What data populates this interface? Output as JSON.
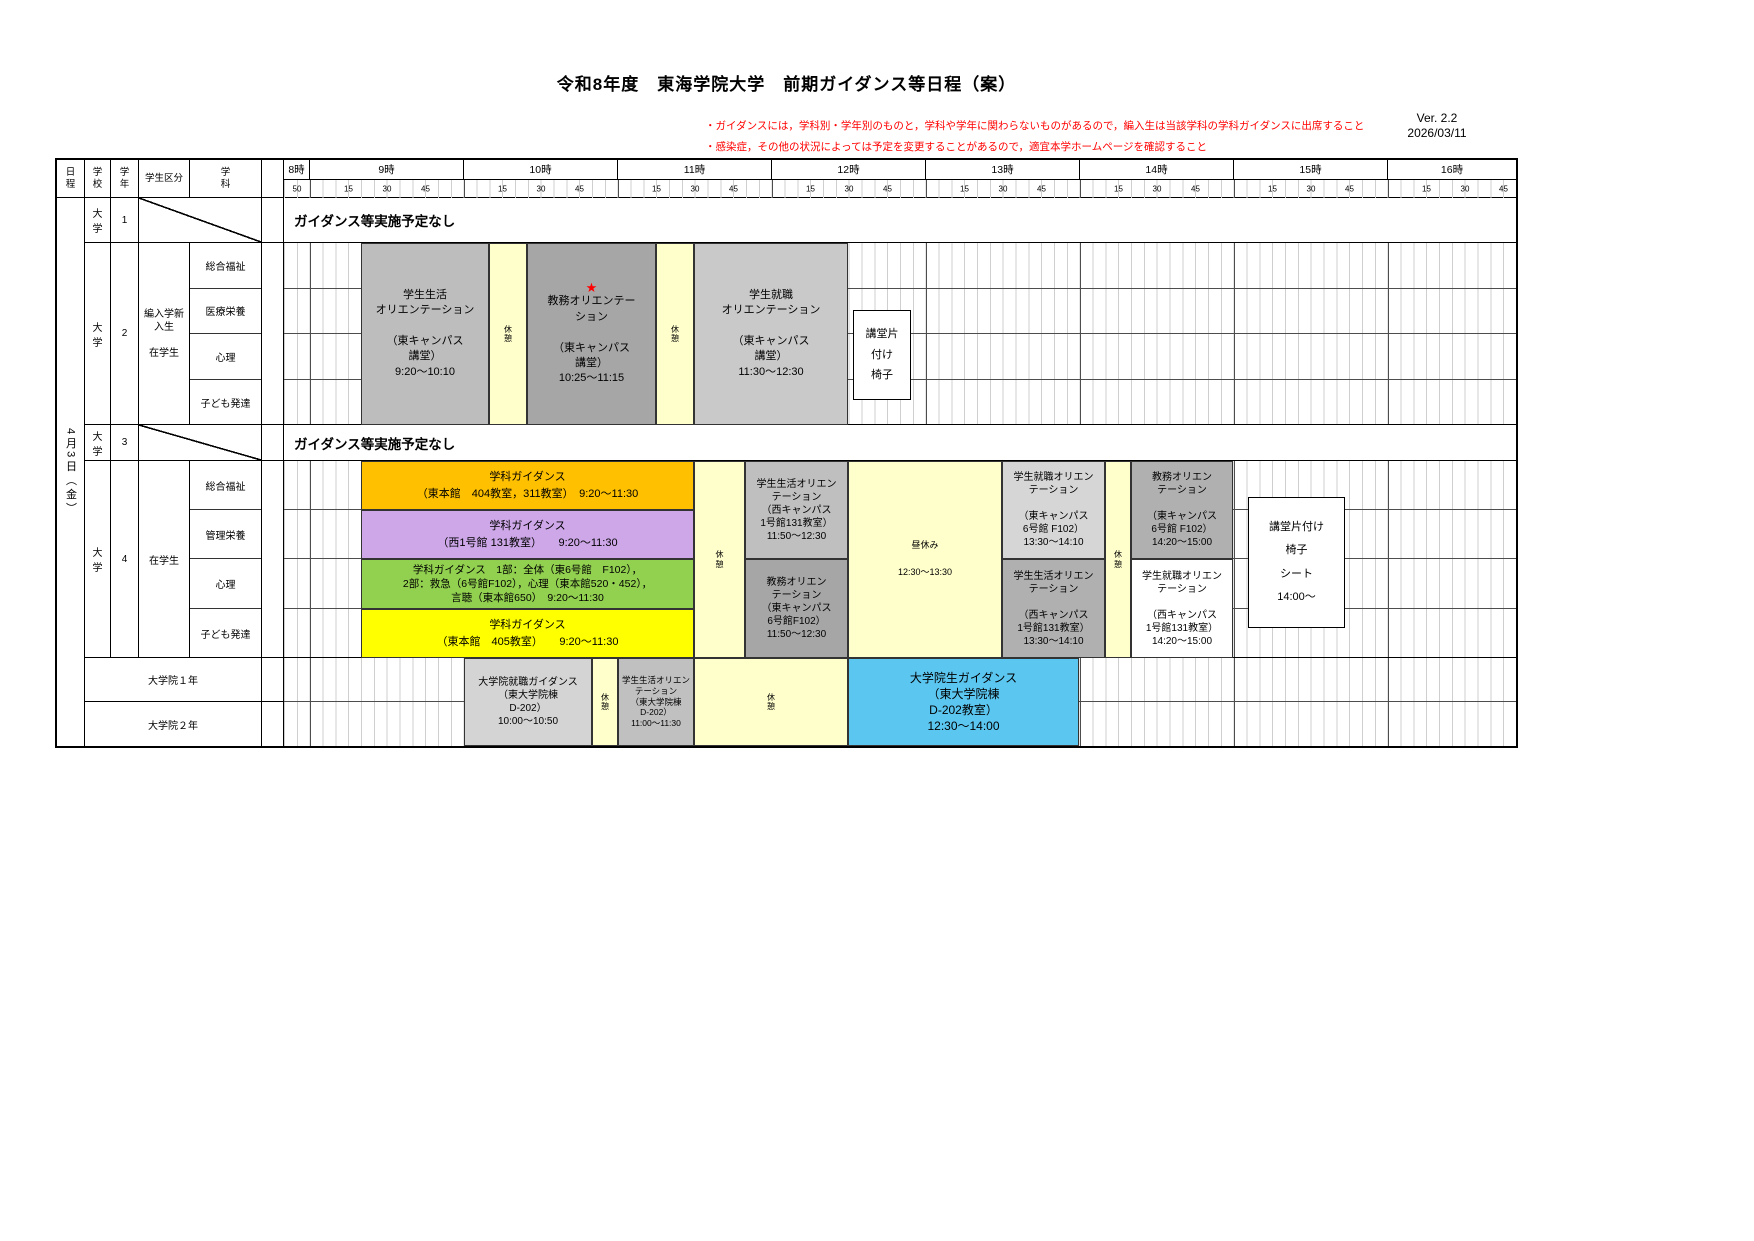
{
  "title": "令和8年度　東海学院大学　前期ガイダンス等日程（案）",
  "version": {
    "line1": "Ver. 2.2",
    "line2": "2026/03/11"
  },
  "notes": [
    "・ガイダンスには，学科別・学年別のものと，学科や学年に関わらないものがあるので，編入生は当該学科の学科ガイダンスに出席すること",
    "・感染症，その他の状況によっては予定を変更することがあるので，適宜本学ホームページを確認すること"
  ],
  "header": {
    "date": "日\n程",
    "school": "学\n校",
    "grade": "学\n年",
    "category": "学生区分",
    "department": "学\n科"
  },
  "timeline": {
    "hours": [
      "8時",
      "9時",
      "10時",
      "11時",
      "12時",
      "13時",
      "14時",
      "15時",
      "16時"
    ],
    "m50": "50",
    "m15": "15",
    "m30": "30",
    "m45": "45"
  },
  "date_label": "4月3日（金）",
  "labels": {
    "break": "休\n憩",
    "star": "★"
  },
  "colors": {
    "break_bg": "#FFFFCC",
    "gray_mid": "#BDBDBD",
    "gray_dark": "#A6A6A6",
    "gray_light": "#D6D6D6",
    "orange": "#FFC000",
    "purple": "#CDA7E8",
    "green": "#92D050",
    "yellow": "#FFFF00",
    "blue": "#5BC6F0",
    "note_red": "#FF0000"
  },
  "rows": {
    "r1": {
      "school": "大\n学",
      "grade": "1",
      "none_text": "ガイダンス等実施予定なし"
    },
    "r2": {
      "school": "大\n学",
      "grade": "2",
      "category": "編入学新\n入生\n\n在学生",
      "departments": [
        "総合福祉",
        "医療栄養",
        "心理",
        "子ども発達"
      ],
      "events": {
        "seikatsu": "学生生活\nオリエンテーション\n\n（東キャンパス\n講堂）\n9:20～10:10",
        "kyomu": "教務オリエンテー\nション\n\n（東キャンパス\n講堂）\n10:25～11:15",
        "shushoku": "学生就職\nオリエンテーション\n\n（東キャンパス\n講堂）\n11:30～12:30",
        "kodo_box": "講堂片\n付け\n椅子"
      }
    },
    "r3": {
      "school": "大\n学",
      "grade": "3",
      "none_text": "ガイダンス等実施予定なし"
    },
    "r4": {
      "school": "大\n学",
      "grade": "4",
      "category": "在学生",
      "departments": [
        "総合福祉",
        "管理栄養",
        "心理",
        "子ども発達"
      ],
      "events": {
        "bar_sogo": "学科ガイダンス\n（東本館　404教室，311教室）　9:20～11:30",
        "bar_kanri": "学科ガイダンス\n（西1号館 131教室）　　9:20～11:30",
        "bar_shinri": "学科ガイダンス　1部：全体（東6号館　F102），\n2部：救急（6号館F102），心理（東本館520・452），\n言聴（東本館650）　9:20～11:30",
        "bar_kodomo": "学科ガイダンス\n（東本館　405教室）　　9:20～11:30",
        "seikatsu1": "学生生活オリエン\nテーション\n（西キャンパス\n1号館131教室）\n11:50～12:30",
        "kyomu1": "教務オリエン\nテーション\n（東キャンパス\n6号館F102）\n11:50～12:30",
        "lunch": "昼休み\n\n12:30～13:30",
        "shushoku2": "学生就職オリエン\nテーション\n\n（東キャンパス\n6号館 F102）\n13:30～14:10",
        "seikatsu2": "学生生活オリエン\nテーション\n\n（西キャンパス\n1号館131教室）\n13:30～14:10",
        "kyomu2": "教務オリエン\nテーション\n\n（東キャンパス\n6号館 F102）\n14:20～15:00",
        "shushoku3": "学生就職オリエン\nテーション\n\n（西キャンパス\n1号館131教室）\n14:20～15:00",
        "kodo_box": "講堂片付け\n椅子\nシート\n14:00～"
      }
    },
    "grad": {
      "row1_label": "大学院１年",
      "row2_label": "大学院２年",
      "events": {
        "shushoku": "大学院就職ガイダンス\n（東大学院棟\nD-202）\n10:00～10:50",
        "seikatsu": "学生生活オリエン\nテーション\n（東大学院棟\nD-202）\n11:00～11:30",
        "guidance": "大学院生ガイダンス\n（東大学院棟\nD-202教室）\n12:30～14:00"
      }
    }
  }
}
